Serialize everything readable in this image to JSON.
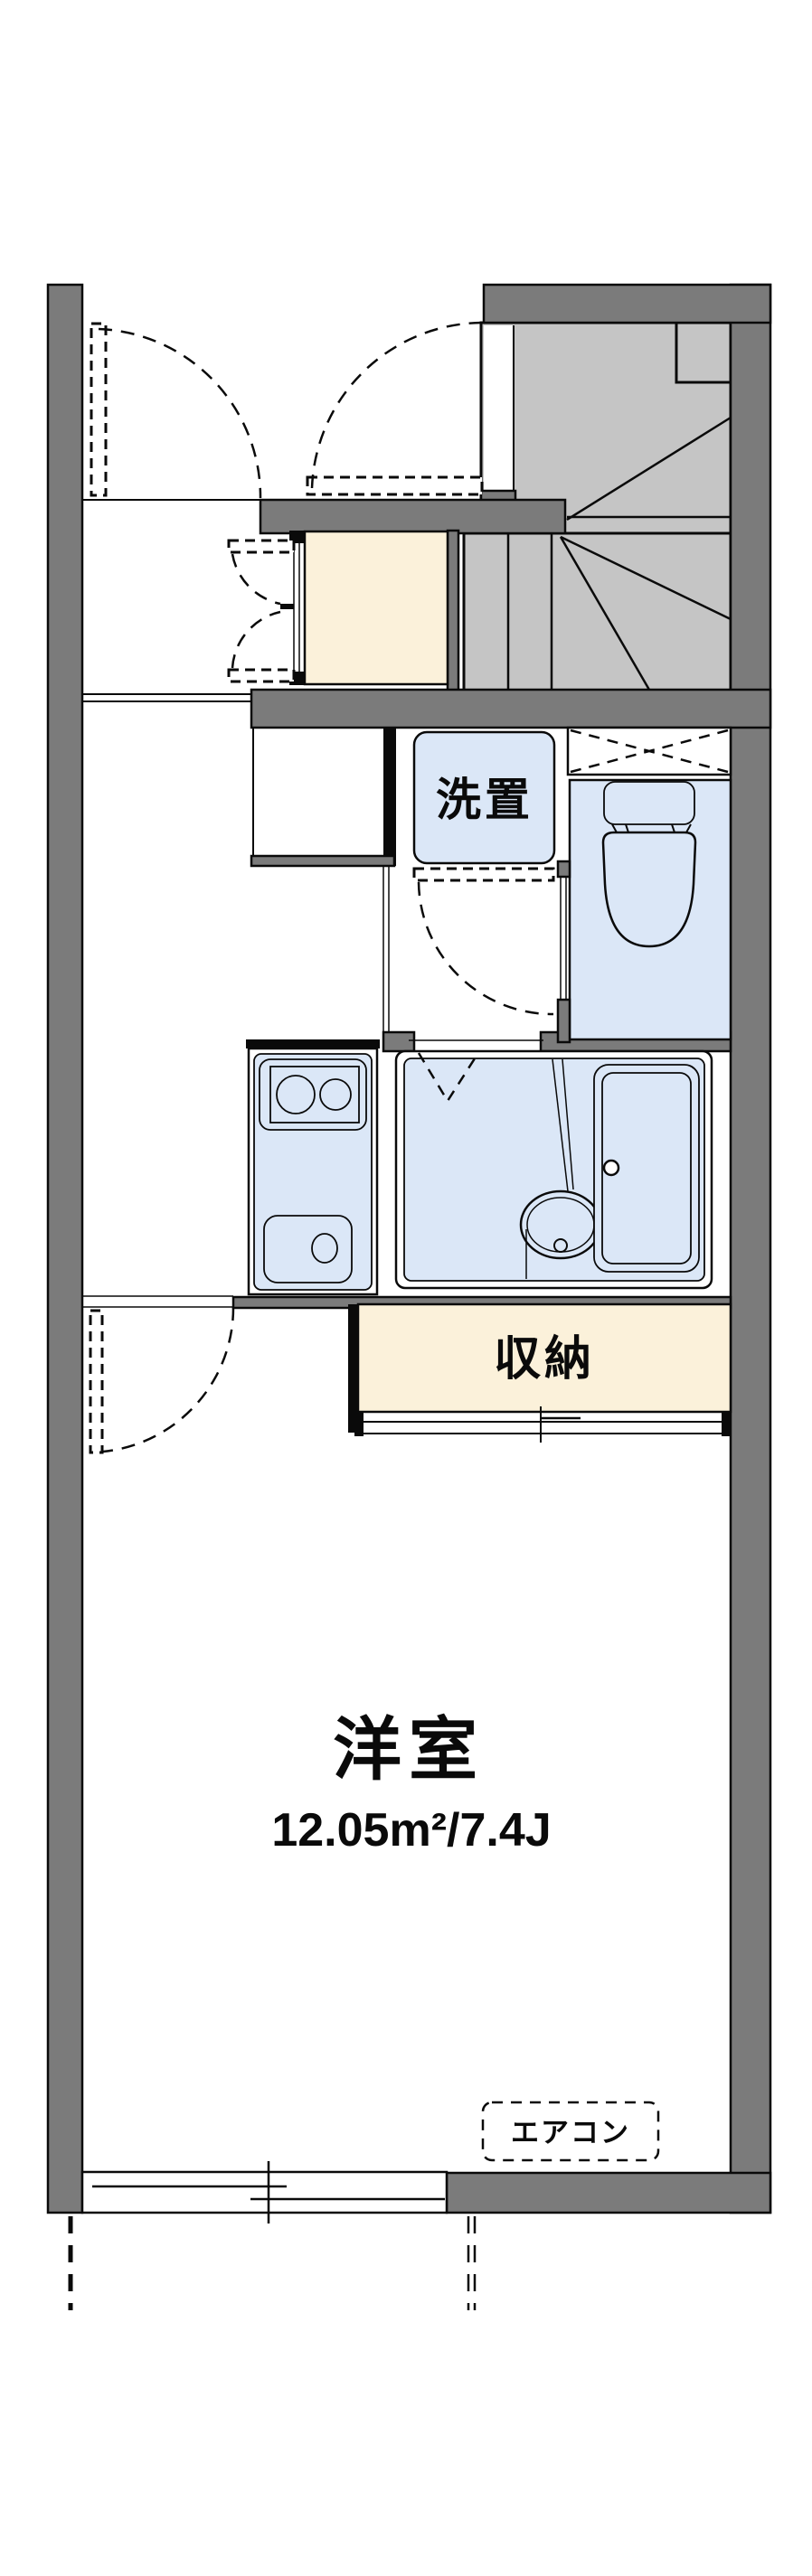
{
  "plan": {
    "type": "apartment-floor-plan",
    "labels": {
      "washer_space": "洗置",
      "storage": "収納",
      "room_name": "洋室",
      "room_area": "12.05m²/7.4J",
      "air_conditioner": "エアコン"
    },
    "rooms": [
      {
        "name": "洋室",
        "area_m2": "12.05",
        "tatami": "7.4J"
      },
      {
        "name": "収納"
      },
      {
        "name": "洗置"
      }
    ]
  },
  "colors": {
    "wall": "#7b7b7b",
    "stair": "#c5c5c5",
    "fixture": "#dbe7f7",
    "closet": "#fbf1da",
    "line": "#0a0a0a",
    "bg": "#ffffff"
  }
}
